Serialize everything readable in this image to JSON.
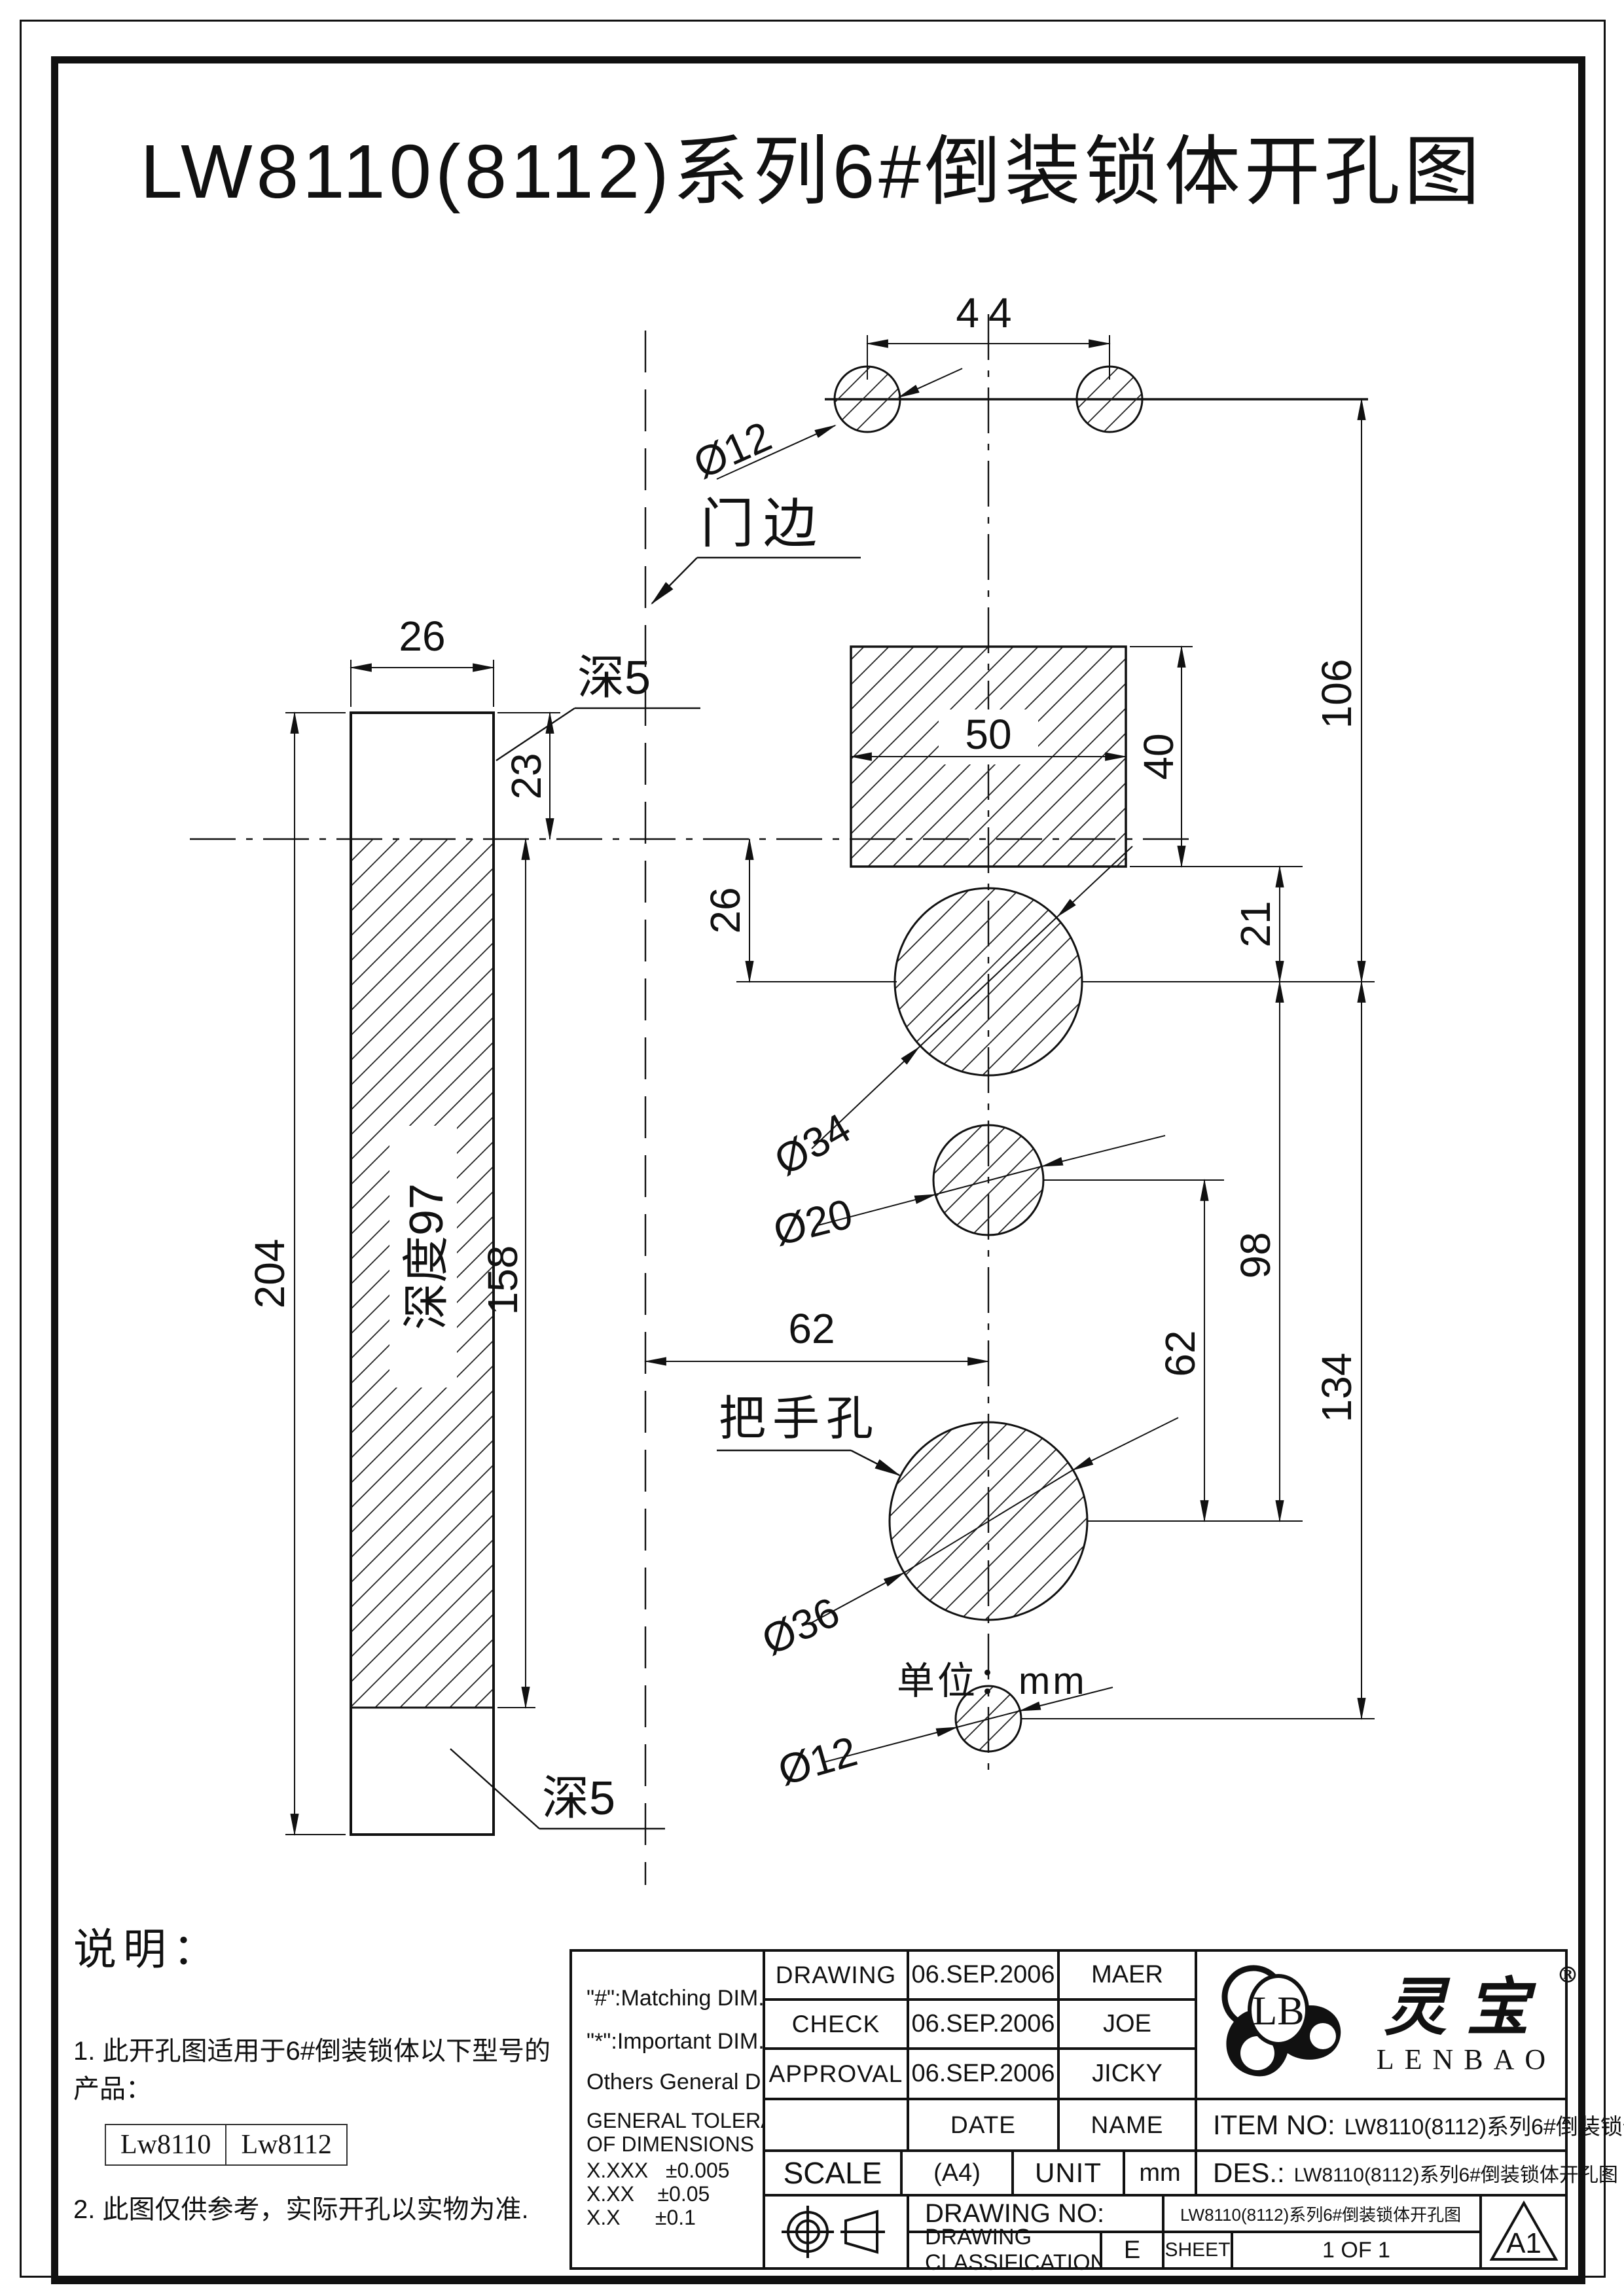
{
  "page": {
    "title": "LW8110(8112)系列6#倒装锁体开孔图"
  },
  "drawing": {
    "labels": {
      "d44": "44",
      "dia12_top": "Ø12",
      "door_edge": "门边",
      "d26_bar": "26",
      "depth5_top": "深5",
      "d23": "23",
      "d50": "50",
      "d40": "40",
      "d106": "106",
      "d26_v": "26",
      "d21": "21",
      "dia34": "Ø34",
      "d204": "204",
      "depth97": "深度97",
      "d158": "158",
      "dia20": "Ø20",
      "d62_h": "62",
      "d62_v": "62",
      "d98": "98",
      "d134": "134",
      "handle_hole": "把手孔",
      "dia36": "Ø36",
      "dia12_bottom": "Ø12",
      "depth5_bottom": "深5",
      "unit": "单位：mm"
    }
  },
  "notes": {
    "heading": "说明：",
    "note1": "1. 此开孔图适用于6#倒装锁体以下型号的产品：",
    "models": [
      "Lw8110",
      "Lw8112"
    ],
    "note2": "2. 此图仅供参考，实际开孔以实物为准."
  },
  "title_block": {
    "rows": [
      {
        "label": "DRAWING",
        "date": "06.SEP.2006",
        "name": "MAER"
      },
      {
        "label": "CHECK",
        "date": "06.SEP.2006",
        "name": "JOE"
      },
      {
        "label": "APPROVAL",
        "date": "06.SEP.2006",
        "name": "JICKY"
      }
    ],
    "date_header": "DATE",
    "name_header": "NAME",
    "dim_notes": [
      "\"#\":Matching  DIM.",
      "\"*\":Important  DIM.",
      "Others General  DIM."
    ],
    "tolerance_line1": "GENERAL TOLERANCE",
    "tolerance_line2": "OF DIMENSIONS",
    "tolerances": [
      [
        "X.XXX",
        "±0.005"
      ],
      [
        "X.XX",
        "±0.05"
      ],
      [
        "X.X",
        "±0.1"
      ]
    ],
    "scale_label": "SCALE",
    "paper": "(A4)",
    "unit_label": "UNIT",
    "unit_value": "mm",
    "item_no_label": "ITEM NO:",
    "item_no": "LW8110(8112)系列6#倒装锁体开孔图",
    "des_label": "DES.:",
    "des": "LW8110(8112)系列6#倒装锁体开孔图",
    "drawing_no_label": "DRAWING NO:",
    "drawing_no": "LW8110(8112)系列6#倒装锁体开孔图",
    "classification_label": "DRAWING CLASSIFICATION",
    "classification": "E",
    "sheet_label": "SHEET",
    "sheet": "1 OF 1",
    "size_code": "A1",
    "brand": {
      "monogram": "LB",
      "cn": "灵宝",
      "reg": "®",
      "en": "LENBAO"
    }
  }
}
